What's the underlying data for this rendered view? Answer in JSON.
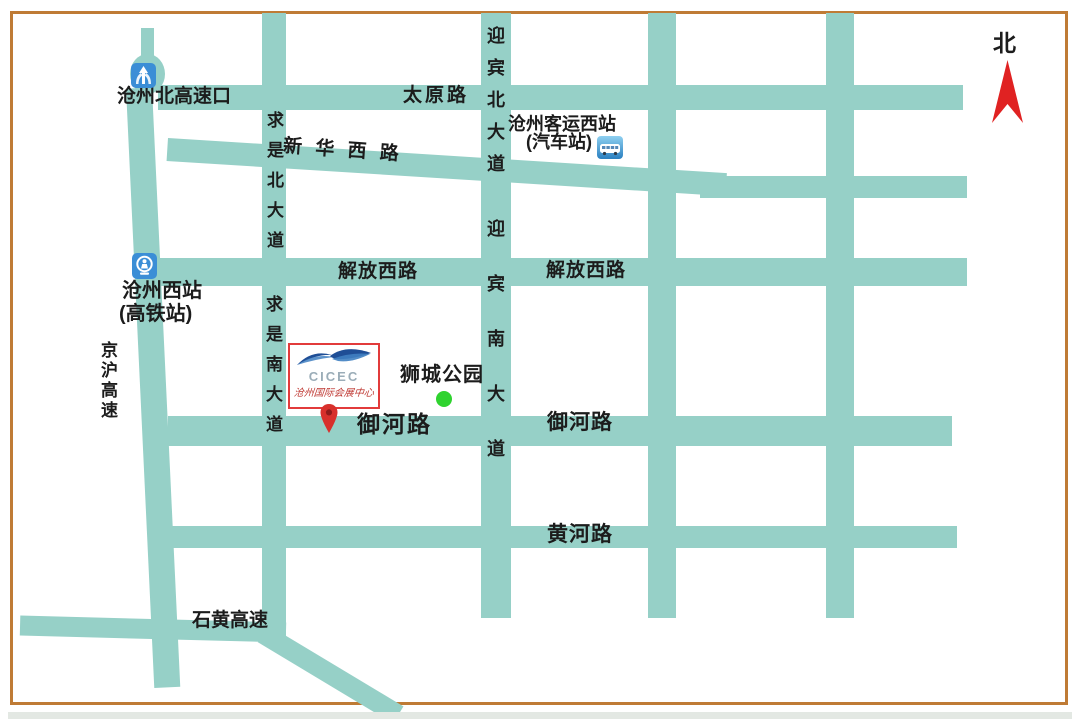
{
  "map_title": "CICEC location map (Cangzhou)",
  "compass": {
    "north_label": "北"
  },
  "roads": {
    "taiyuan": "太原路",
    "xinhua_west": "新 华 西 路",
    "jiefang_west_1": "解放西路",
    "jiefang_west_2": "解放西路",
    "yuhe_1": "御河路",
    "yuhe_2": "御河路",
    "huanghe": "黄河路",
    "shihuang_expwy": "石黄高速",
    "jinghu_expwy": "京沪高速",
    "qiushi_north_ave": "求是北大道",
    "qiushi_south_ave": "求是南大道",
    "yingbin_north_ave": "迎宾北大道",
    "yingbin_south_ave": "迎宾南大道"
  },
  "pois": {
    "cangzhou_north_exit": {
      "label": "沧州北高速口",
      "icon": "highway-interchange-icon"
    },
    "cangzhou_west_station": {
      "label": "沧州西站",
      "sub": "(高铁站)",
      "icon": "train-station-icon"
    },
    "keyun_west_station": {
      "label": "沧州客运西站",
      "sub": "(汽车站)",
      "icon": "bus-station-icon"
    },
    "shicheng_park": {
      "label": "狮城公园",
      "marker": "green-dot"
    }
  },
  "venue": {
    "logo_text": "CICEC",
    "name": "沧州国际会展中心",
    "marker": "location-pin"
  },
  "colors": {
    "road": "#96d0c7",
    "border": "#bf7b35",
    "north_arrow": "#e02222",
    "pin": "#d8302c",
    "pin_inner": "#8f1b1b",
    "park_dot": "#2fd32f",
    "cicec_border": "#e23b3b",
    "logo_dark_blue": "#1f4e96",
    "logo_light_blue": "#3f7fc1",
    "icon_blue": "#3b8ed6"
  }
}
